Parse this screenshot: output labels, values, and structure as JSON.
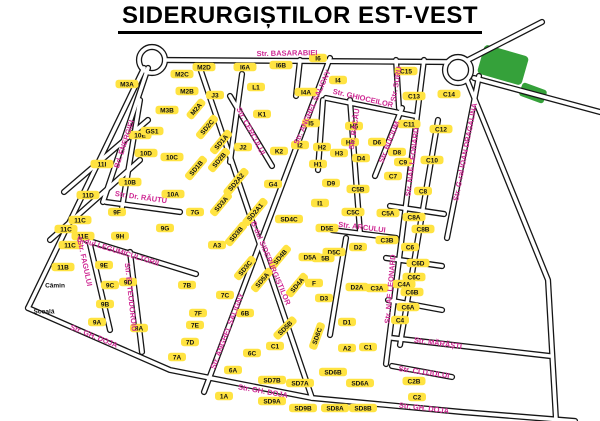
{
  "title": "SIDERURGIȘTILOR EST-VEST",
  "map": {
    "colors": {
      "block_fill": "#ffe341",
      "block_text": "#101010",
      "street_label": "#cf2a94",
      "road_casing": "#161616",
      "green_area": "#35a13a",
      "background": "#ffffff"
    },
    "blocks": [
      {
        "label": "M3A",
        "x": 127,
        "y": 84
      },
      {
        "label": "M3B",
        "x": 167,
        "y": 110
      },
      {
        "label": "M2B",
        "x": 187,
        "y": 91
      },
      {
        "label": "M2C",
        "x": 182,
        "y": 74
      },
      {
        "label": "M2D",
        "x": 204,
        "y": 67
      },
      {
        "label": "M2A",
        "x": 196,
        "y": 109,
        "rot": -50
      },
      {
        "label": "SD2C",
        "x": 207,
        "y": 127,
        "rot": -50
      },
      {
        "label": "J3",
        "x": 215,
        "y": 95
      },
      {
        "label": "J2",
        "x": 243,
        "y": 147
      },
      {
        "label": "K1",
        "x": 262,
        "y": 114
      },
      {
        "label": "K2",
        "x": 279,
        "y": 151
      },
      {
        "label": "I2",
        "x": 300,
        "y": 145
      },
      {
        "label": "I5",
        "x": 311,
        "y": 123
      },
      {
        "label": "I4A",
        "x": 306,
        "y": 92
      },
      {
        "label": "I4",
        "x": 338,
        "y": 80
      },
      {
        "label": "L1",
        "x": 256,
        "y": 87
      },
      {
        "label": "I6A",
        "x": 245,
        "y": 67
      },
      {
        "label": "I6B",
        "x": 281,
        "y": 65
      },
      {
        "label": "I6",
        "x": 318,
        "y": 58
      },
      {
        "label": "H2",
        "x": 322,
        "y": 147
      },
      {
        "label": "H1",
        "x": 318,
        "y": 164
      },
      {
        "label": "H3",
        "x": 339,
        "y": 153
      },
      {
        "label": "H4",
        "x": 350,
        "y": 142
      },
      {
        "label": "H6",
        "x": 354,
        "y": 126
      },
      {
        "label": "D6",
        "x": 377,
        "y": 142
      },
      {
        "label": "D4",
        "x": 361,
        "y": 158
      },
      {
        "label": "D9",
        "x": 331,
        "y": 183
      },
      {
        "label": "D8",
        "x": 397,
        "y": 152
      },
      {
        "label": "G4",
        "x": 273,
        "y": 184
      },
      {
        "label": "I1",
        "x": 320,
        "y": 203
      },
      {
        "label": "C15",
        "x": 406,
        "y": 71
      },
      {
        "label": "C13",
        "x": 414,
        "y": 96
      },
      {
        "label": "C11",
        "x": 409,
        "y": 124
      },
      {
        "label": "C14",
        "x": 449,
        "y": 94
      },
      {
        "label": "C12",
        "x": 441,
        "y": 129
      },
      {
        "label": "C10",
        "x": 432,
        "y": 160
      },
      {
        "label": "C9",
        "x": 403,
        "y": 162
      },
      {
        "label": "C7",
        "x": 393,
        "y": 176
      },
      {
        "label": "C8",
        "x": 423,
        "y": 191
      },
      {
        "label": "C5B",
        "x": 358,
        "y": 189
      },
      {
        "label": "C5C",
        "x": 353,
        "y": 212
      },
      {
        "label": "C5A",
        "x": 388,
        "y": 213
      },
      {
        "label": "C8A",
        "x": 414,
        "y": 217
      },
      {
        "label": "C8B",
        "x": 423,
        "y": 229
      },
      {
        "label": "C3B",
        "x": 387,
        "y": 240
      },
      {
        "label": "D2",
        "x": 358,
        "y": 247
      },
      {
        "label": "C6",
        "x": 410,
        "y": 247
      },
      {
        "label": "C6D",
        "x": 418,
        "y": 263
      },
      {
        "label": "C6C",
        "x": 414,
        "y": 277
      },
      {
        "label": "C4A",
        "x": 404,
        "y": 284
      },
      {
        "label": "C6B",
        "x": 412,
        "y": 292
      },
      {
        "label": "C6A",
        "x": 408,
        "y": 307
      },
      {
        "label": "C4",
        "x": 400,
        "y": 320
      },
      {
        "label": "C3A",
        "x": 377,
        "y": 288
      },
      {
        "label": "D2A",
        "x": 357,
        "y": 287
      },
      {
        "label": "D5E",
        "x": 327,
        "y": 228
      },
      {
        "label": "D5C",
        "x": 334,
        "y": 252
      },
      {
        "label": "D5B",
        "x": 323,
        "y": 258
      },
      {
        "label": "D5A",
        "x": 310,
        "y": 257
      },
      {
        "label": "F",
        "x": 314,
        "y": 283
      },
      {
        "label": "D3",
        "x": 324,
        "y": 298
      },
      {
        "label": "D1",
        "x": 347,
        "y": 322
      },
      {
        "label": "A2",
        "x": 347,
        "y": 348
      },
      {
        "label": "C1",
        "x": 368,
        "y": 347
      },
      {
        "label": "10E",
        "x": 140,
        "y": 135
      },
      {
        "label": "GS1",
        "x": 152,
        "y": 131
      },
      {
        "label": "10D",
        "x": 146,
        "y": 153
      },
      {
        "label": "10C",
        "x": 172,
        "y": 157
      },
      {
        "label": "10B",
        "x": 130,
        "y": 182
      },
      {
        "label": "10A",
        "x": 173,
        "y": 194
      },
      {
        "label": "11I",
        "x": 102,
        "y": 164
      },
      {
        "label": "11D",
        "x": 88,
        "y": 195
      },
      {
        "label": "9F",
        "x": 117,
        "y": 212
      },
      {
        "label": "11C",
        "x": 80,
        "y": 220
      },
      {
        "label": "11C",
        "x": 66,
        "y": 229
      },
      {
        "label": "11E",
        "x": 83,
        "y": 236
      },
      {
        "label": "11C",
        "x": 70,
        "y": 245
      },
      {
        "label": "9H",
        "x": 120,
        "y": 236
      },
      {
        "label": "9G",
        "x": 165,
        "y": 228
      },
      {
        "label": "11B",
        "x": 63,
        "y": 267
      },
      {
        "label": "9E",
        "x": 104,
        "y": 265
      },
      {
        "label": "9C",
        "x": 110,
        "y": 285
      },
      {
        "label": "9D",
        "x": 128,
        "y": 282
      },
      {
        "label": "9B",
        "x": 105,
        "y": 304
      },
      {
        "label": "9A",
        "x": 97,
        "y": 322
      },
      {
        "label": "8A",
        "x": 139,
        "y": 328
      },
      {
        "label": "Cămin",
        "x": 55,
        "y": 285,
        "text_only": true
      },
      {
        "label": "Școală",
        "x": 44,
        "y": 311,
        "text_only": true
      },
      {
        "label": "7A",
        "x": 177,
        "y": 357
      },
      {
        "label": "7G",
        "x": 195,
        "y": 212
      },
      {
        "label": "A3",
        "x": 217,
        "y": 245
      },
      {
        "label": "SD1A",
        "x": 221,
        "y": 142,
        "rot": -50
      },
      {
        "label": "SD1B",
        "x": 196,
        "y": 168,
        "rot": -50
      },
      {
        "label": "SD2B",
        "x": 219,
        "y": 160,
        "rot": -50
      },
      {
        "label": "SD2A2",
        "x": 236,
        "y": 182,
        "rot": -50
      },
      {
        "label": "SD3A",
        "x": 221,
        "y": 204,
        "rot": -50
      },
      {
        "label": "SD2A1",
        "x": 255,
        "y": 212,
        "rot": -50
      },
      {
        "label": "SD3B",
        "x": 236,
        "y": 234,
        "rot": -50
      },
      {
        "label": "SD3C",
        "x": 245,
        "y": 268,
        "rot": -50
      },
      {
        "label": "SD4B",
        "x": 280,
        "y": 257,
        "rot": -50
      },
      {
        "label": "SD4A",
        "x": 297,
        "y": 285,
        "rot": -50
      },
      {
        "label": "SD5A",
        "x": 262,
        "y": 280,
        "rot": -50
      },
      {
        "label": "SD4C",
        "x": 289,
        "y": 219
      },
      {
        "label": "SD5B",
        "x": 285,
        "y": 328,
        "rot": -45
      },
      {
        "label": "SD6C",
        "x": 317,
        "y": 336,
        "rot": -70
      },
      {
        "label": "SD6B",
        "x": 333,
        "y": 372
      },
      {
        "label": "SD6A",
        "x": 360,
        "y": 383
      },
      {
        "label": "SD7B",
        "x": 272,
        "y": 380
      },
      {
        "label": "SD7A",
        "x": 300,
        "y": 383
      },
      {
        "label": "SD9A",
        "x": 272,
        "y": 401
      },
      {
        "label": "SD9B",
        "x": 303,
        "y": 408
      },
      {
        "label": "SD8A",
        "x": 335,
        "y": 408
      },
      {
        "label": "SD8B",
        "x": 363,
        "y": 408
      },
      {
        "label": "7B",
        "x": 187,
        "y": 285
      },
      {
        "label": "7C",
        "x": 225,
        "y": 295
      },
      {
        "label": "7F",
        "x": 198,
        "y": 313
      },
      {
        "label": "7E",
        "x": 195,
        "y": 325
      },
      {
        "label": "7D",
        "x": 190,
        "y": 342
      },
      {
        "label": "6B",
        "x": 245,
        "y": 313
      },
      {
        "label": "C1",
        "x": 275,
        "y": 346
      },
      {
        "label": "6C",
        "x": 252,
        "y": 353
      },
      {
        "label": "6A",
        "x": 233,
        "y": 370
      },
      {
        "label": "1A",
        "x": 224,
        "y": 396
      },
      {
        "label": "C2B",
        "x": 414,
        "y": 381
      },
      {
        "label": "C2",
        "x": 417,
        "y": 397
      }
    ],
    "streets": [
      {
        "name": "Str. BASARABIEI",
        "x": 287,
        "y": 53,
        "rot": -1
      },
      {
        "name": "Bd. ENERGIEI",
        "x": 124,
        "y": 144,
        "rot": -72
      },
      {
        "name": "Str. CERCULUI",
        "x": 251,
        "y": 131,
        "rot": 62
      },
      {
        "name": "Str. GHIOCEILOR",
        "x": 363,
        "y": 98,
        "rot": 13
      },
      {
        "name": "Str. BACĂU",
        "x": 354,
        "y": 129,
        "rot": -82
      },
      {
        "name": "Str. BUCIUM",
        "x": 389,
        "y": 142,
        "rot": -68
      },
      {
        "name": "Str. SURU",
        "x": 396,
        "y": 84,
        "rot": -80
      },
      {
        "name": "Str. NAE LEONARD",
        "x": 412,
        "y": 162,
        "rot": -83
      },
      {
        "name": "Str. NAE LEONARD",
        "x": 390,
        "y": 289,
        "rot": -85
      },
      {
        "name": "Str. G-ral IOAN DRAGALINA",
        "x": 465,
        "y": 152,
        "rot": -79
      },
      {
        "name": "Str. Dr. RĂUTU",
        "x": 141,
        "y": 197,
        "rot": 8
      },
      {
        "name": "Str. ARCULUI",
        "x": 362,
        "y": 227,
        "rot": 7
      },
      {
        "name": "B-dul SIDERURGIȘTILOR",
        "x": 271,
        "y": 263,
        "rot": 67
      },
      {
        "name": "Str. ANGHEL SALIGNY",
        "x": 312,
        "y": 107,
        "rot": -66
      },
      {
        "name": "Str. ANGHEL SALIGNY",
        "x": 227,
        "y": 331,
        "rot": -69
      },
      {
        "name": "Str. E. TEODOROIU",
        "x": 131,
        "y": 297,
        "rot": 84
      },
      {
        "name": "Str. FAGULUI",
        "x": 85,
        "y": 263,
        "rot": 78
      },
      {
        "name": "B-dul LEGUMICULTORII",
        "x": 118,
        "y": 251,
        "rot": 17
      },
      {
        "name": "Str. GH. DOJA",
        "x": 94,
        "y": 336,
        "rot": 22
      },
      {
        "name": "Str. GH. DOJA",
        "x": 263,
        "y": 391,
        "rot": 10
      },
      {
        "name": "Str. GH. DOJA",
        "x": 424,
        "y": 408,
        "rot": 7
      },
      {
        "name": "Str. MĂRĂȘTI",
        "x": 438,
        "y": 343,
        "rot": 8
      },
      {
        "name": "Str. CLUJULUI",
        "x": 424,
        "y": 372,
        "rot": 8
      }
    ]
  }
}
